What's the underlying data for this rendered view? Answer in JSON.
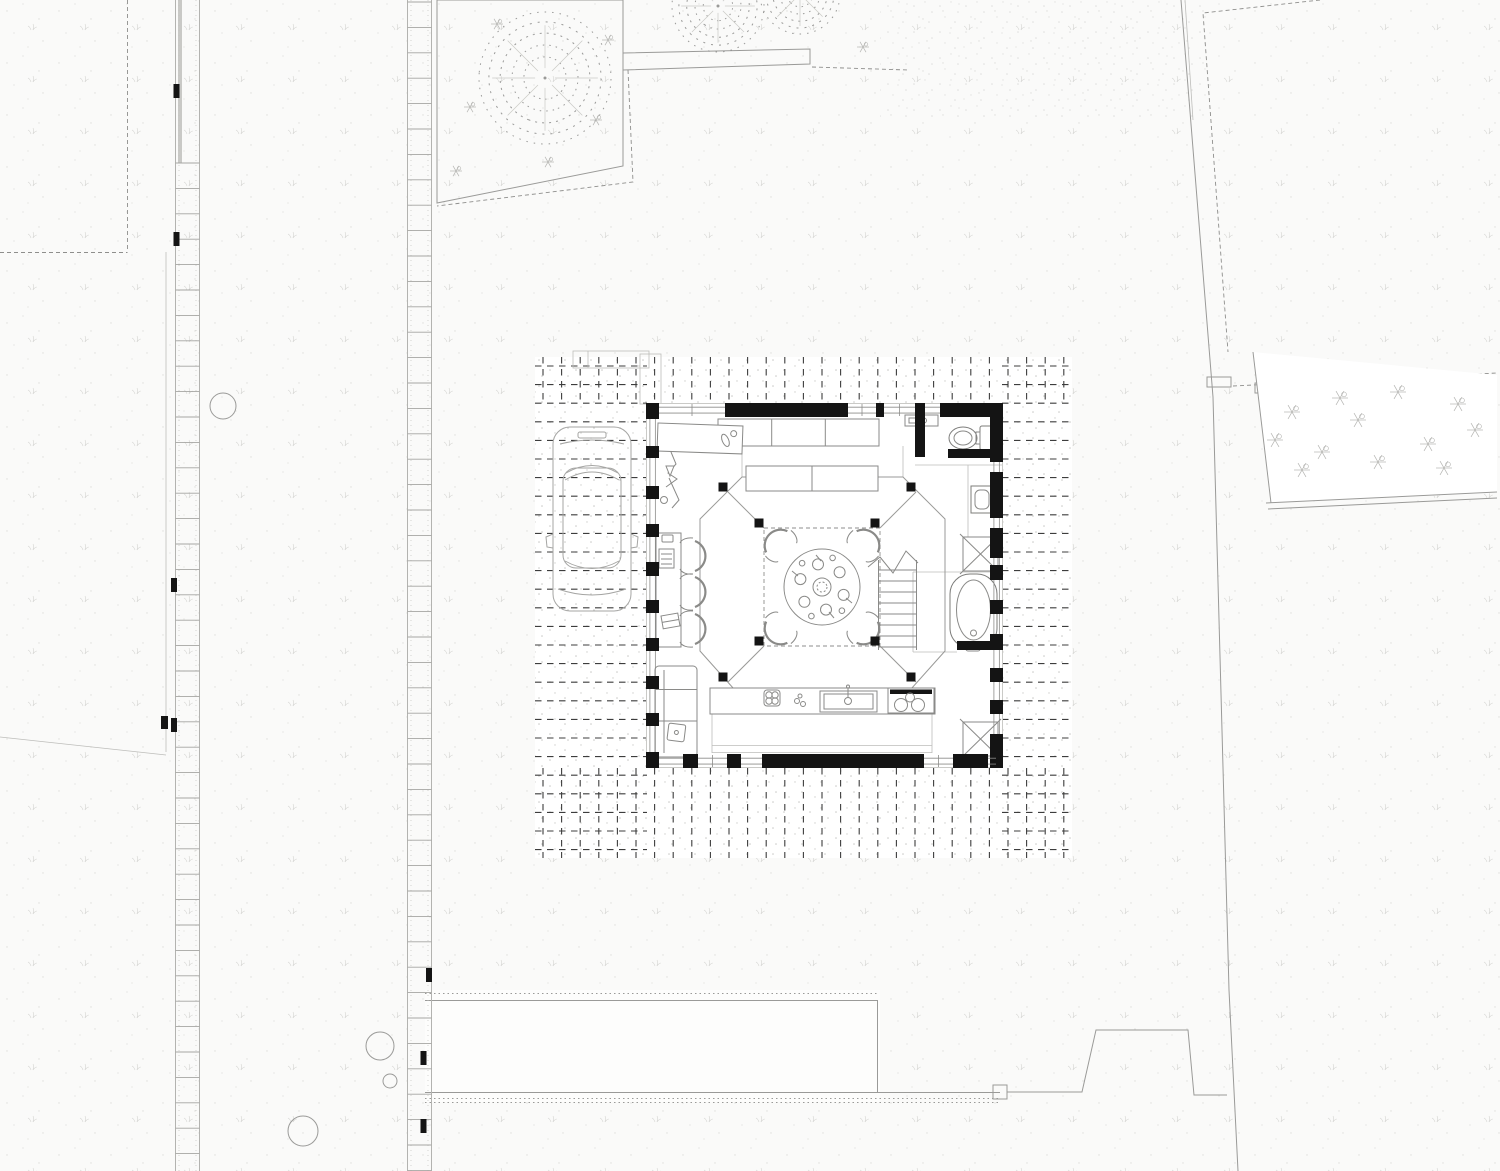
{
  "meta": {
    "title": "Architectural site plan — square pavilion house, ground floor with surrounding deck, driveway car, paths and planting",
    "drawing_type": "site / floor plan",
    "orientation": "top view"
  },
  "palette": {
    "paper": "#fafaf9",
    "ink": "#141414",
    "deck_dash": "#3d3d3d",
    "line_mid": "#777776",
    "line_light": "#9a9a98",
    "line_faint": "#c9c9c6"
  },
  "deck": {
    "x0": 535,
    "y0": 357,
    "x1": 1072,
    "y1": 858,
    "gap": 18.6,
    "bx0": 647,
    "by0": 403,
    "bx1": 1002,
    "by1": 768
  },
  "strips": [
    {
      "x0": 175.5,
      "x1": 199.5,
      "rung0": 163,
      "ties": [
        [
          173.5,
          84
        ],
        [
          173.5,
          232
        ],
        [
          171,
          578
        ],
        [
          171,
          718
        ]
      ]
    },
    {
      "x0": 407.5,
      "x1": 431.5,
      "rung0": 2,
      "ties": [
        [
          426,
          968
        ],
        [
          420.5,
          1051
        ],
        [
          420.5,
          1119
        ]
      ]
    }
  ],
  "walls": {
    "top": {
      "y": 403,
      "th": 14,
      "segs": [
        [
          646,
          659
        ],
        [
          725,
          848
        ],
        [
          876,
          884
        ],
        [
          915,
          923
        ],
        [
          940,
          1003
        ]
      ]
    },
    "bottom": {
      "y": 754,
      "th": 14,
      "segs": [
        [
          646,
          659
        ],
        [
          683,
          698
        ],
        [
          727,
          741
        ],
        [
          762,
          924
        ],
        [
          953,
          988
        ],
        [
          996,
          1003
        ]
      ]
    },
    "left": {
      "x": 646,
      "th": 13,
      "segs": [
        [
          403,
          419
        ],
        [
          446,
          458
        ],
        [
          486,
          499
        ],
        [
          524,
          537
        ],
        [
          562,
          576
        ],
        [
          600,
          613
        ],
        [
          638,
          651
        ],
        [
          676,
          689
        ],
        [
          713,
          726
        ],
        [
          752,
          768
        ]
      ]
    },
    "right": {
      "x": 990,
      "th": 13,
      "segs": [
        [
          403,
          462
        ],
        [
          472,
          518
        ],
        [
          528,
          558
        ],
        [
          565,
          580
        ],
        [
          600,
          614
        ],
        [
          634,
          650
        ],
        [
          668,
          682
        ],
        [
          700,
          714
        ],
        [
          734,
          768
        ]
      ]
    }
  },
  "inner_walls": [
    [
      915,
      403,
      10,
      54
    ],
    [
      948,
      449,
      45,
      9
    ],
    [
      957,
      641,
      46,
      9
    ]
  ],
  "posts": {
    "size": 9,
    "positions": [
      [
        723,
        487
      ],
      [
        911,
        487
      ],
      [
        723,
        677
      ],
      [
        911,
        677
      ],
      [
        759,
        523
      ],
      [
        875,
        523
      ],
      [
        759,
        641
      ],
      [
        875,
        641
      ]
    ]
  },
  "trees": [
    {
      "cx": 545,
      "cy": 78,
      "r": 66
    },
    {
      "cx": 718,
      "cy": 6,
      "r": 46
    },
    {
      "cx": 800,
      "cy": -6,
      "r": 40
    }
  ],
  "glyphs": {
    "top_left_bed": [
      [
        470,
        107
      ],
      [
        456,
        171
      ],
      [
        497,
        24
      ],
      [
        596,
        120
      ],
      [
        548,
        162
      ],
      [
        608,
        40
      ],
      [
        863,
        47
      ]
    ],
    "right_bed": [
      [
        1292,
        412
      ],
      [
        1322,
        452
      ],
      [
        1358,
        420
      ],
      [
        1398,
        392
      ],
      [
        1428,
        444
      ],
      [
        1458,
        404
      ],
      [
        1302,
        470
      ],
      [
        1378,
        462
      ],
      [
        1444,
        468
      ],
      [
        1340,
        398
      ],
      [
        1475,
        430
      ],
      [
        1275,
        440
      ]
    ]
  },
  "site_features": [
    "left paved path strip",
    "middle paved path strip",
    "parcel boundary dashed lines",
    "planting bed with stippled trees (top)",
    "low wall / bench bar (top)",
    "right planting bed with shrubs",
    "right property boundary line",
    "bottom walkway bands with gate post and fence",
    "tree-trunk circles",
    "timber deck with dashed board pattern around house",
    "parked car on drive"
  ],
  "building": {
    "rooms": [
      "open living hall",
      "central octagonal pavilion / dining",
      "wc (top right)",
      "bath with tub (right)",
      "stair flight (centre right)",
      "kitchen strip (bottom)"
    ],
    "furniture": [
      "round dining table with 4 chairs and place settings",
      "wall cabinets (top)",
      "work table (top left)",
      "coat stand sculpture",
      "desk with 3 chairs (left)",
      "sofa with side cushion (bottom left)",
      "kitchen counter with sink and hob",
      "toilet",
      "hand basin",
      "bathtub",
      "two shower/rooflight squares marked X"
    ]
  }
}
